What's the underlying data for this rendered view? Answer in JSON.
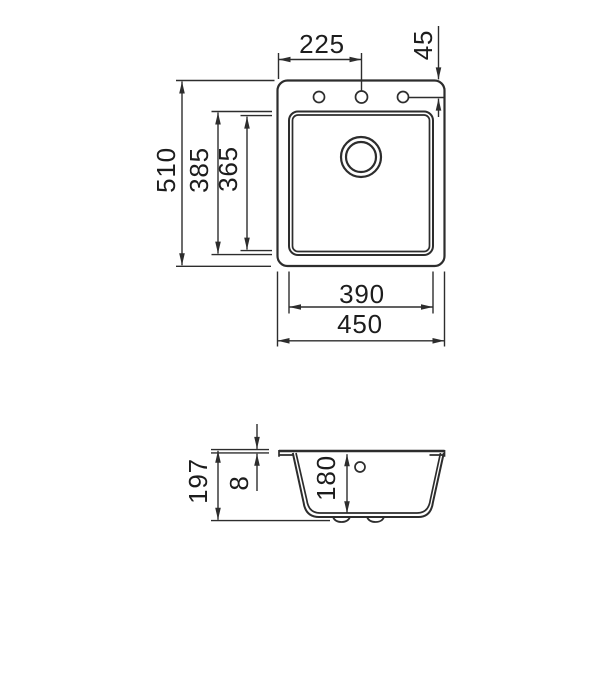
{
  "drawing": {
    "line_color": "#2d2d2d",
    "background_color": "#ffffff",
    "top_view": {
      "dim_faucet_offset": "225",
      "dim_hole_inset": "45",
      "dim_overall_length": "510",
      "dim_bowl_outer_length": "385",
      "dim_bowl_inner_length": "365",
      "dim_bowl_width": "390",
      "dim_overall_width": "450"
    },
    "section_view": {
      "dim_overall_height": "197",
      "dim_rim_height": "8",
      "dim_bowl_depth": "180"
    }
  }
}
